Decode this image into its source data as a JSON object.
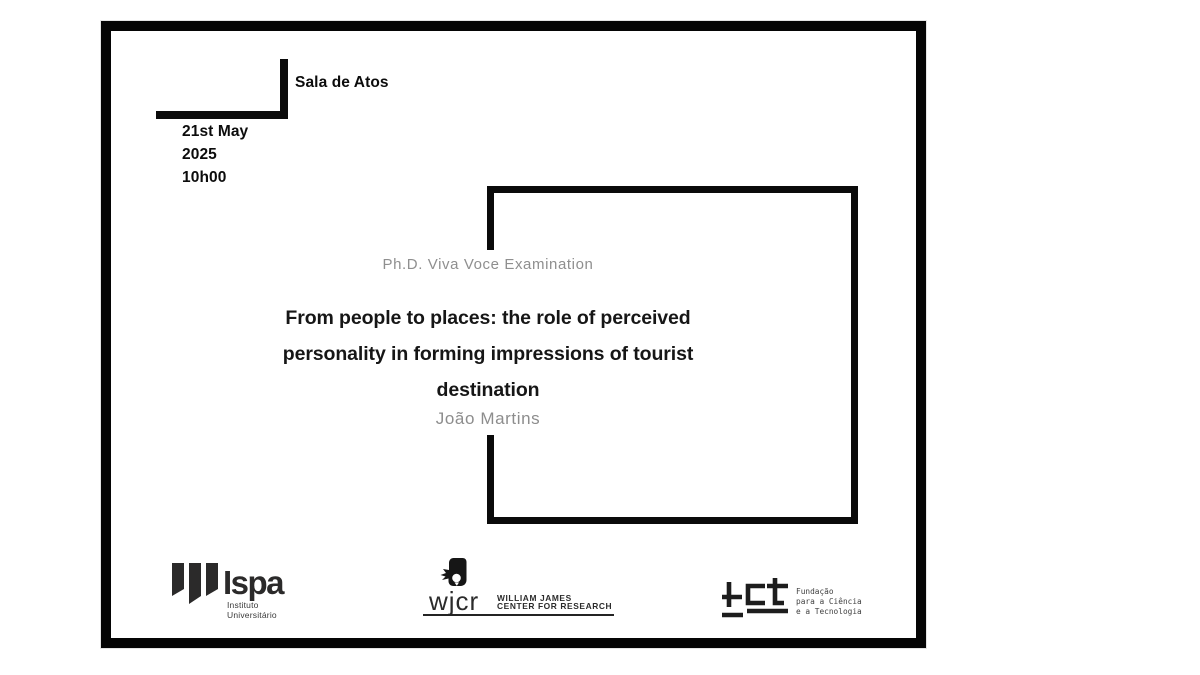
{
  "slide": {
    "room": "Sala de Atos",
    "date": [
      "21st May",
      "2025",
      "10h00"
    ],
    "eyebrow": "Ph.D. Viva Voce Examination",
    "title_lines": [
      "From people to places: the role of perceived",
      "personality in forming impressions of tourist",
      "destination"
    ],
    "author": "João Martins"
  },
  "logos": {
    "ispa": {
      "wordmark": "Ispa",
      "subtitle": [
        "Instituto",
        "Universitário"
      ]
    },
    "wjcr": {
      "wordmark": "wjcr",
      "name": [
        "WILLIAM JAMES",
        "CENTER FOR RESEARCH"
      ]
    },
    "fct": {
      "wordmark": "fct",
      "name": [
        "Fundação",
        "para a Ciência",
        "e a Tecnologia"
      ]
    }
  },
  "colors": {
    "slide_border": "#050505",
    "frame_border": "#0a0a0a",
    "title_text": "#161616",
    "muted_text": "#8f8f8f",
    "logo_dark": "#2b2a2a",
    "background": "#ffffff"
  }
}
